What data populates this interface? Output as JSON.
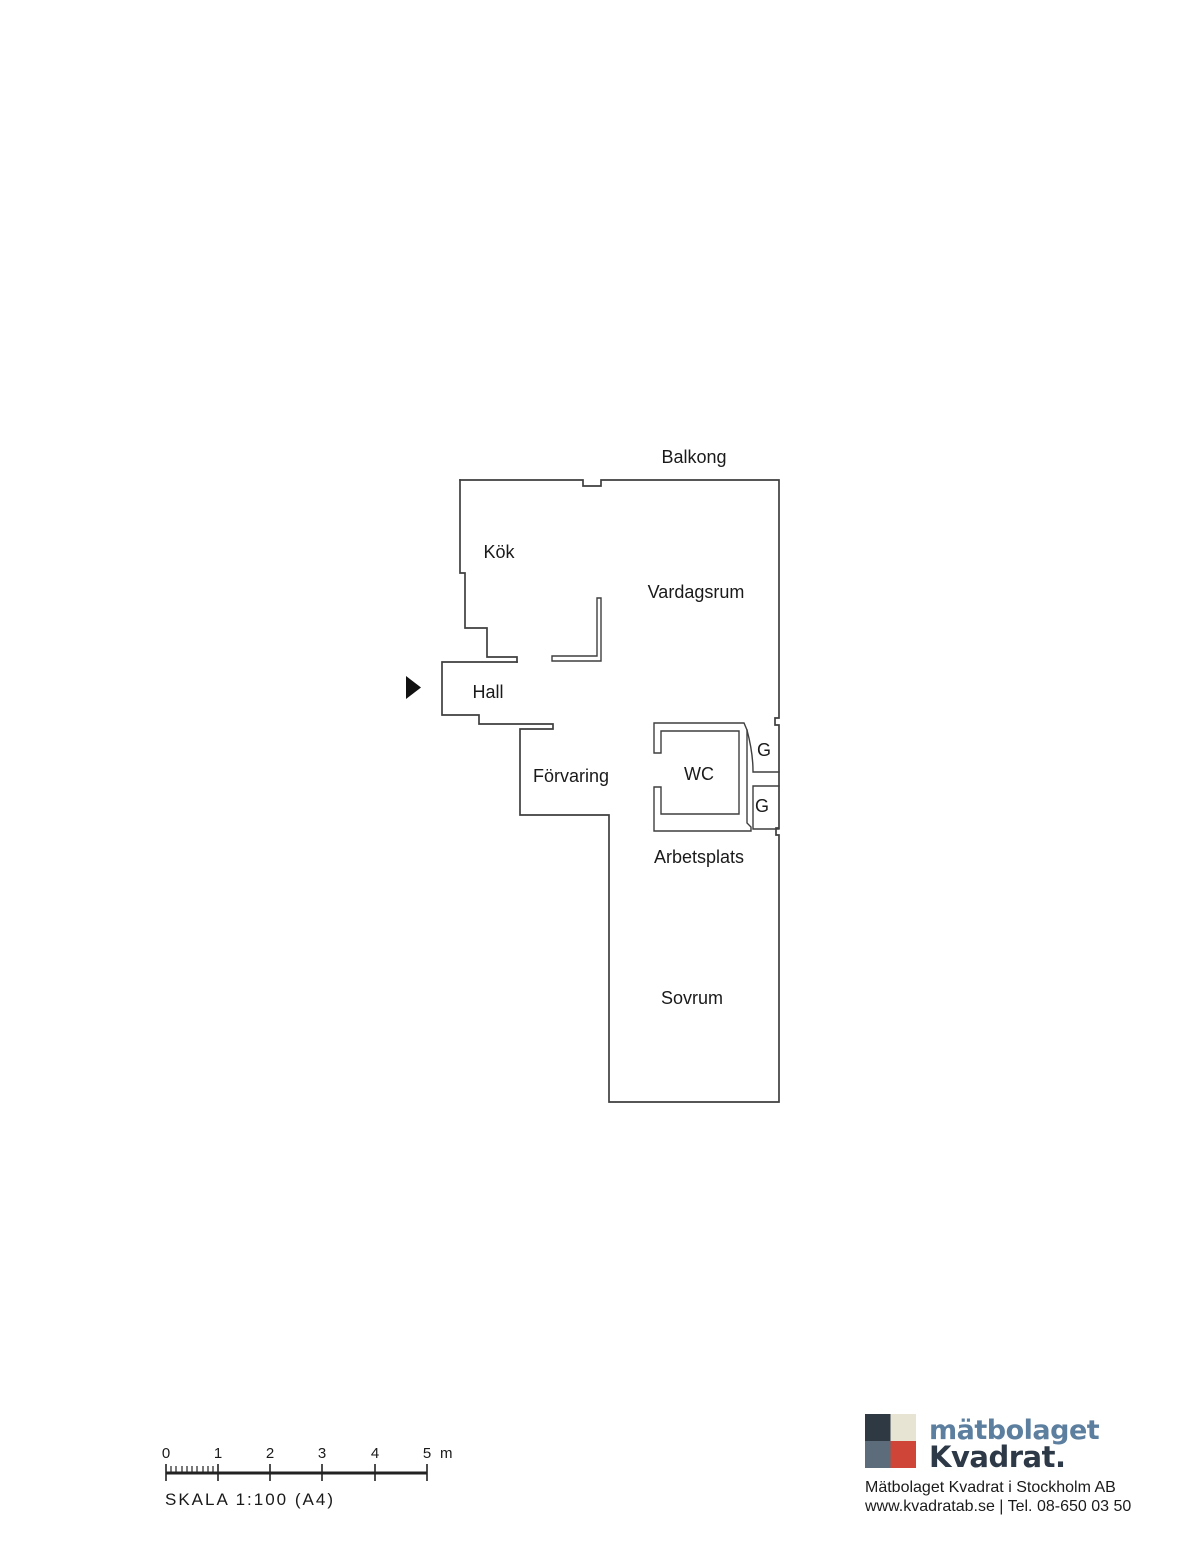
{
  "plan": {
    "wall_color": "#3f3f3f",
    "entrance_arrow_color": "#111111",
    "rooms": [
      {
        "name": "balkong",
        "label": "Balkong"
      },
      {
        "name": "kok",
        "label": "Kök"
      },
      {
        "name": "vardagsrum",
        "label": "Vardagsrum"
      },
      {
        "name": "hall",
        "label": "Hall"
      },
      {
        "name": "forvaring",
        "label": "Förvaring"
      },
      {
        "name": "wc",
        "label": "WC"
      },
      {
        "name": "garderob-upper",
        "label": "G"
      },
      {
        "name": "garderob-lower",
        "label": "G"
      },
      {
        "name": "arbetsplats",
        "label": "Arbetsplats"
      },
      {
        "name": "sovrum",
        "label": "Sovrum"
      }
    ]
  },
  "scale_bar": {
    "tick_labels": [
      "0",
      "1",
      "2",
      "3",
      "4",
      "5"
    ],
    "unit": "m",
    "caption": "SKALA 1:100 (A4)"
  },
  "footer": {
    "brand": {
      "line1": "mätbolaget",
      "line2": "Kvadrat."
    },
    "company_line": "Mätbolaget Kvadrat i Stockholm AB",
    "contact_line": "www.kvadratab.se | Tel. 08-650 03 50",
    "colors": {
      "square_top_left": "#2e3944",
      "square_top_right": "#e8e4d4",
      "square_bottom_left": "#5d6c7a",
      "square_bottom_right": "#cf4638",
      "brand_blue": "#5d7f9f",
      "brand_dark": "#2e3947"
    }
  }
}
